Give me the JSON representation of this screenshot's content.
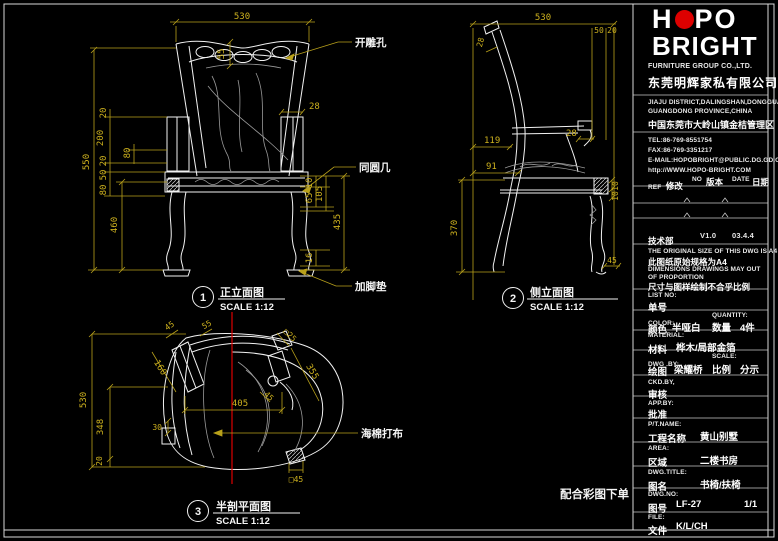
{
  "colors": {
    "background": "#000000",
    "linework": "#f2f2f2",
    "dimension": "#b9a11b",
    "accent_red": "#dd0000",
    "soft_gray": "#9a9a9a"
  },
  "drawing": {
    "front": {
      "badge": "1",
      "title": "正立面图",
      "scale": "SCALE 1:12",
      "ann": {
        "hole": "开雕孔",
        "table": "同圆几",
        "pad": "加脚垫"
      },
      "dims": {
        "w": "530",
        "crest": "55",
        "h": "550",
        "s20a": "20",
        "s200": "200",
        "s20b": "20",
        "s80a": "80",
        "s50": "50",
        "s80b": "80",
        "s460": "460",
        "arm": "28",
        "r10": "10",
        "r105": "105",
        "r65": "65",
        "r435": "435",
        "r16": "16"
      }
    },
    "side": {
      "badge": "2",
      "title": "侧立面图",
      "scale": "SCALE 1:12",
      "dims": {
        "d": "530",
        "t50": "50",
        "t20": "20",
        "back": "28",
        "off119": "119",
        "off91": "91",
        "h370": "370",
        "arm": "28",
        "r10a": "10",
        "r10b": "10",
        "f45": "45"
      }
    },
    "plan": {
      "badge": "3",
      "title": "半剖平面图",
      "scale": "SCALE 1:12",
      "ann": {
        "foam": "海棉打布"
      },
      "dims": {
        "h530": "530",
        "h348": "348",
        "h20": "20",
        "leg30": "30",
        "a45": "45",
        "a55": "55",
        "a160": "160",
        "a25": "□25",
        "a355": "355",
        "a45b": "45",
        "w405": "405",
        "b45": "□45"
      }
    },
    "note": "配合彩图下单"
  },
  "titleblock": {
    "logo": {
      "pre": "H",
      "post": "PO",
      "line2": "BRIGHT"
    },
    "company_en": "FURNITURE GROUP CO.,LTD.",
    "company_cn": "东莞明辉家私有限公司",
    "addr1": "JIAJU DISTRICT,DALINGSHAN,DONGGUAN",
    "addr2": "GUANGDONG PROVINCE,CHINA",
    "addr_cn": "中国东莞市大岭山镇金桔管理区",
    "tel": "TEL:86-769-8551754",
    "fax": "FAX:86-769-3351217",
    "email": "E-MAIL:HOPOBRIGHT@PUBLIC.DG.GD.CN",
    "web": "http://WWW.HOPO-BRIGHT.COM",
    "rev": {
      "ref": "REF",
      "ref_cn": "修改",
      "no": "NO",
      "no_cn": "版本",
      "date": "DATE",
      "date_cn": "日期"
    },
    "version": {
      "dept": "技术部",
      "ver": "V1.0",
      "date": "03.4.4"
    },
    "notes": {
      "en1": "THE ORIGINAL SIZE OF THIS DWG IS A4",
      "cn1": "此图纸原始规格为A4",
      "en2": "DIMENSIONS DRAWINGS MAY OUT",
      "en3": "OF PROPORTION",
      "cn2": "尺寸与图样绘制不合乎比例"
    },
    "list_no": {
      "label": "LIST NO:",
      "cn": "单号",
      "value": ""
    },
    "color": {
      "label": "COLOR:",
      "cn": "颜色",
      "value": "半哑白"
    },
    "qty": {
      "label": "QUANTITY:",
      "cn": "数量",
      "value": "4件"
    },
    "material": {
      "label": "MATERIAL:",
      "cn": "材料",
      "value": "桦木/局部金箔"
    },
    "dwg_by": {
      "label": "DWG .BY:",
      "cn": "绘图",
      "value": "梁耀桥"
    },
    "scale": {
      "label": "SCALE:",
      "cn": "比例",
      "value": "分示"
    },
    "ckd_by": {
      "label": "CKD.BY,",
      "cn": "审核",
      "value": ""
    },
    "app_by": {
      "label": "APP.BY:",
      "cn": "批准",
      "value": ""
    },
    "pt_name": {
      "label": "P/T.NAME:",
      "cn": "工程名称",
      "value": "黄山别墅"
    },
    "area": {
      "label": "AREA:",
      "cn": "区域",
      "value": "二楼书房"
    },
    "dwg_title": {
      "label": "DWG.TITLE:",
      "cn": "图名",
      "value": "书椅/扶椅"
    },
    "dwg_no": {
      "label": "DWG.NO:",
      "cn": "图号",
      "value": "LF-27",
      "sheet": "1/1"
    },
    "file": {
      "label": "FILE:",
      "cn": "文件",
      "value": "K/L/CH"
    }
  }
}
